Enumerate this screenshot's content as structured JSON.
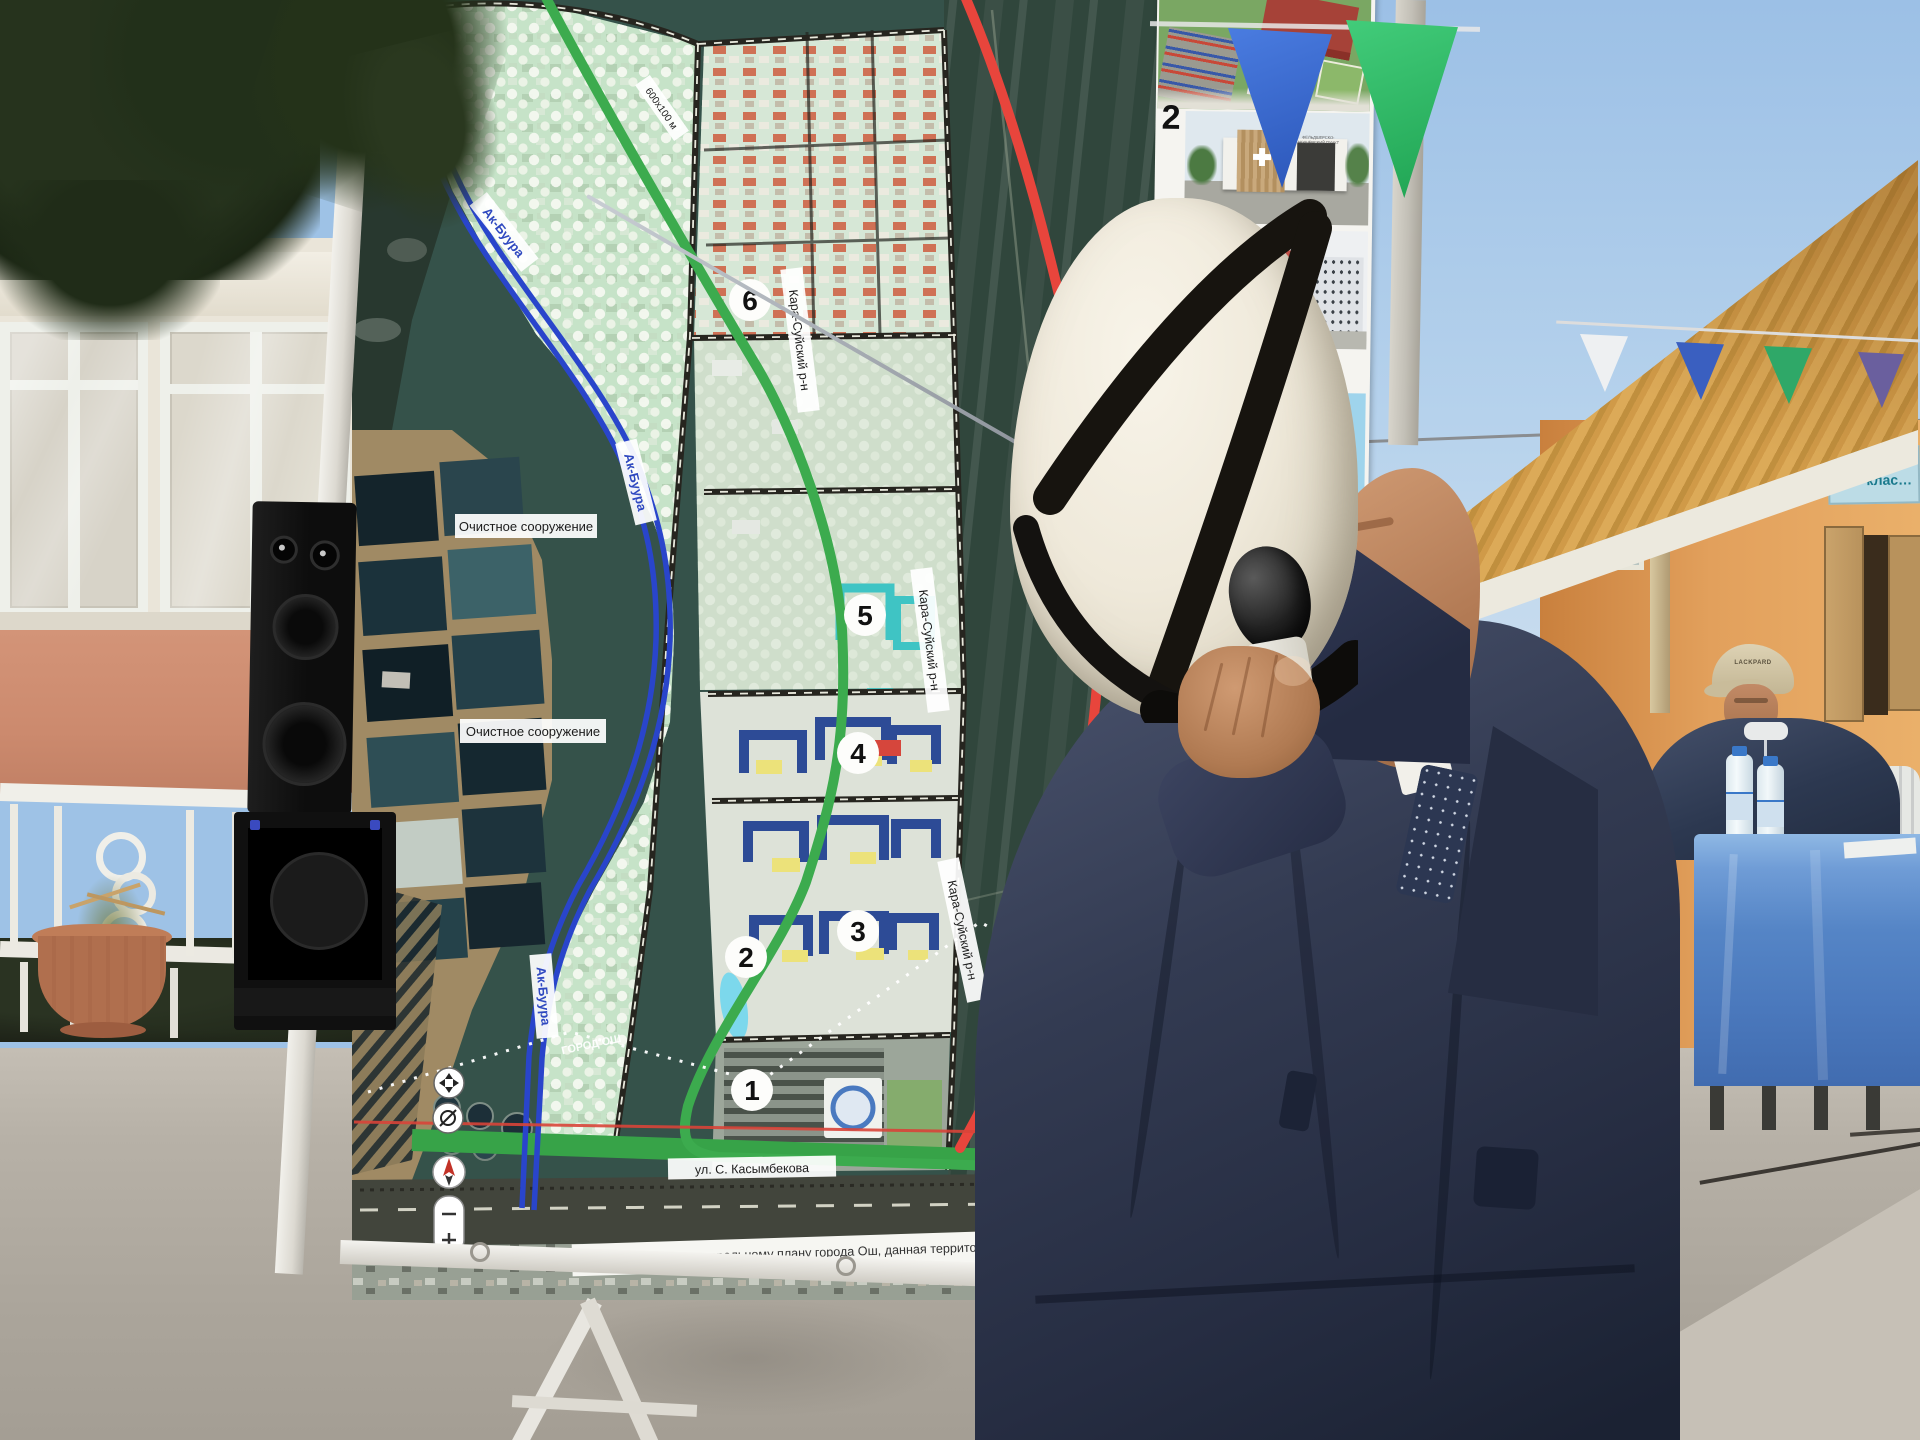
{
  "map": {
    "river_label": "Ак-Буура",
    "treatment_label": "Очистное сооружение",
    "district_label": "Кара-Суйский р-н",
    "boundary_label": "ГОРОД ОШ",
    "street_label": "ул. С. Касымбекова",
    "dimension_label": "600х100 м",
    "note": "Согласно генеральному плану города Ош, данная территория предусмотрена зелёная зона",
    "markers": [
      "1",
      "2",
      "3",
      "4",
      "5",
      "6"
    ]
  },
  "panel": {
    "item_numbers": [
      "2",
      "3",
      "4"
    ],
    "fap_sign": "ФЕЛЬДШЕРСКО-АКУШЕРСКИЙ ПУНКТ",
    "explication": {
      "title": "Экспл…",
      "no_header": "№",
      "rows": [
        {
          "no": "1",
          "text": "Проектиру…"
        },
        {
          "no": "2",
          "text": "Проектируем…"
        },
        {
          "no": "3",
          "text": "Проектируемый … этажный жилой …"
        },
        {
          "no": "4",
          "text": "Проектируемый д…"
        },
        {
          "no": "5",
          "text": "Проектируемая ш…"
        },
        {
          "no": "6",
          "text": "Проектируемые … типовые жилые …"
        }
      ]
    },
    "legend": {
      "title": "Условн…",
      "name_header": "Наим…",
      "rows": [
        {
          "text": "Границ…"
        },
        {
          "text": "Санитарн… очистны…"
        },
        {
          "text": "Санитарн… очистных…"
        },
        {
          "text": "Проектир…"
        },
        {
          "text": "Проектир… ФА…"
        },
        {
          "text": "Проектируемый 4-5 этажный жилой комп…"
        },
        {
          "text": "Проектируемый детск…"
        },
        {
          "text": "Проектируемая школа"
        },
        {
          "text": "Проектируемые 1-этаж… типовые жилые дома"
        },
        {
          "text": "Озеленение"
        }
      ]
    }
  },
  "background": {
    "door_sign_line1": "Баштал…",
    "door_sign_line2": "клас…",
    "cap_text": "LACKPARD"
  },
  "colors": {
    "red_line": "#e04438",
    "green_line": "#3cab4e",
    "river_blue": "#2945cb",
    "sky": "#a9c9e8"
  }
}
